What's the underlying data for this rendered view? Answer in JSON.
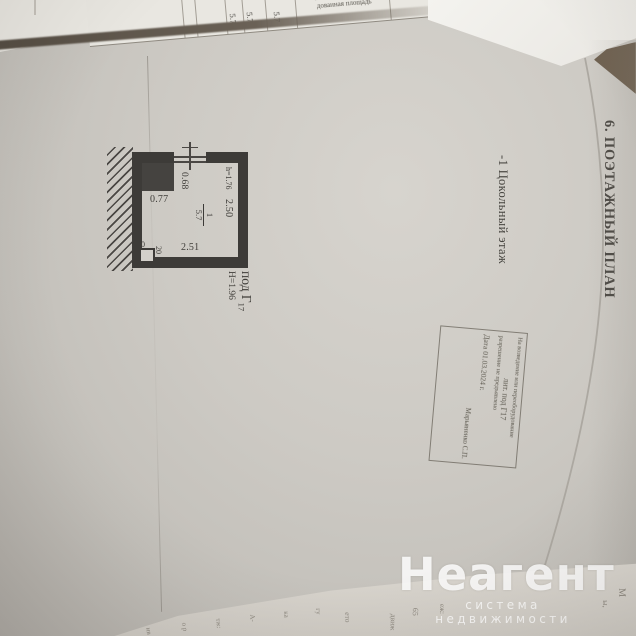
{
  "page": {
    "section_title": "6. ПОЭТАЖНЫЙ ПЛАН",
    "floor_label": "-1 Цокольный этаж",
    "building_label": "под Г",
    "building_label_sub": "17",
    "height_label": "Н=1.96"
  },
  "plan": {
    "room_number": "1",
    "room_area": "5.7",
    "dim_top_opening": "0.68",
    "dim_closet": "0.77",
    "dim_right": "2.50",
    "dim_bottom": "2.51",
    "dim_niche_w": "30",
    "dim_niche_h": "20",
    "height_note": "h=1.76"
  },
  "stamp": {
    "line1": "На возведение или переоборудование",
    "line2": "лит. под Г17",
    "line3": "разрешение не предъявлено",
    "line4": "Дата 01.03.2024 г.",
    "line5": "Марьяненко С.П."
  },
  "top_table": {
    "values": [
      "5.7",
      "5.7",
      "5.7"
    ],
    "header_lines": [
      "Самовольно возведен-",
      "ная или переобору-",
      "дованная площадь"
    ]
  },
  "bottom_fragments": [
    "ив",
    "о р",
    "тж:",
    "А-",
    "ка",
    "гу",
    "ето",
    "движ",
    "65",
    "еж:",
    "ы,",
    "М"
  ],
  "watermark": {
    "brand": "Неагент",
    "tagline": "система недвижимости"
  },
  "colors": {
    "page": "#cdcac4",
    "ink": "#3d3b38",
    "stamp_ink": "#5d594f",
    "watermark": "#ffffff"
  }
}
